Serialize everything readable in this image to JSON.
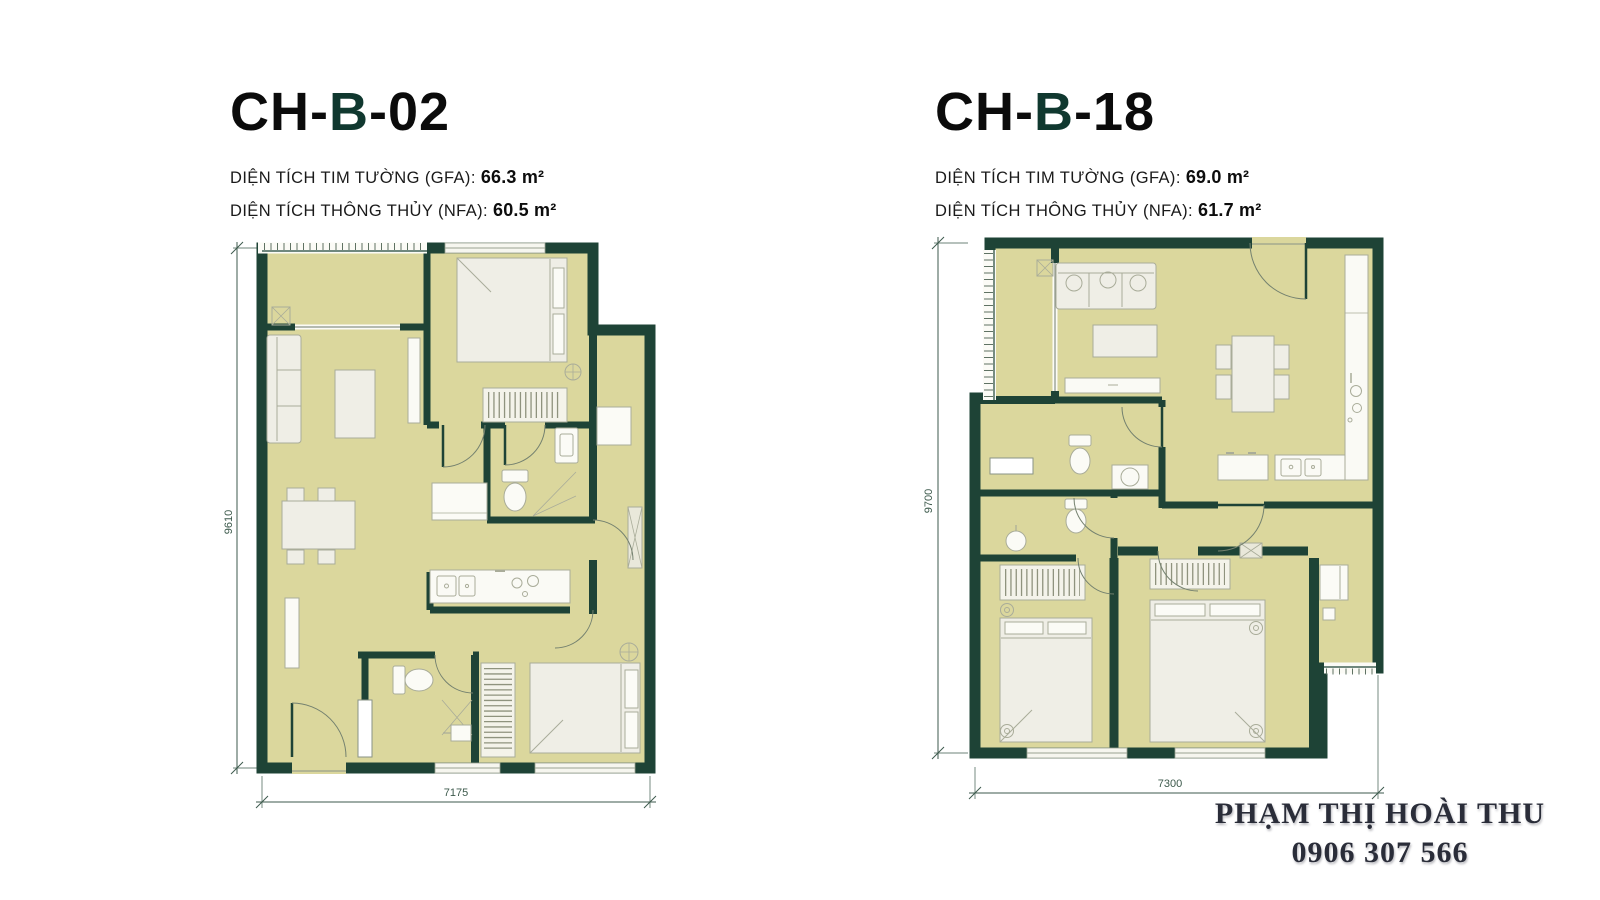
{
  "colors": {
    "wall": "#1e4336",
    "floor": "#dbd79d",
    "furniture_fill": "#efeee6",
    "furniture_stroke": "#a9ac99",
    "title_accent": "#10382f",
    "dimension_line": "#3d5a4c",
    "contact_text": "#2a2d39"
  },
  "plans": [
    {
      "code": "CH-B-02",
      "title": {
        "prefix": "CH-",
        "accent": "B",
        "suffix": "-02"
      },
      "areas": [
        {
          "label": "DIỆN TÍCH TIM TƯỜNG (GFA):",
          "value": "66.3 m²"
        },
        {
          "label": "DIỆN TÍCH THÔNG THỦY (NFA):",
          "value": "60.5 m²"
        }
      ],
      "dimensions": {
        "width": "7175",
        "height": "9610"
      }
    },
    {
      "code": "CH-B-18",
      "title": {
        "prefix": "CH-",
        "accent": "B",
        "suffix": "-18"
      },
      "areas": [
        {
          "label": "DIỆN TÍCH TIM TƯỜNG (GFA):",
          "value": "69.0 m²"
        },
        {
          "label": "DIỆN TÍCH THÔNG THỦY (NFA):",
          "value": "61.7 m²"
        }
      ],
      "dimensions": {
        "width": "7300",
        "height": "9700"
      }
    }
  ],
  "contact": {
    "name": "PHẠM THỊ HOÀI THU",
    "phone": "0906 307 566"
  }
}
